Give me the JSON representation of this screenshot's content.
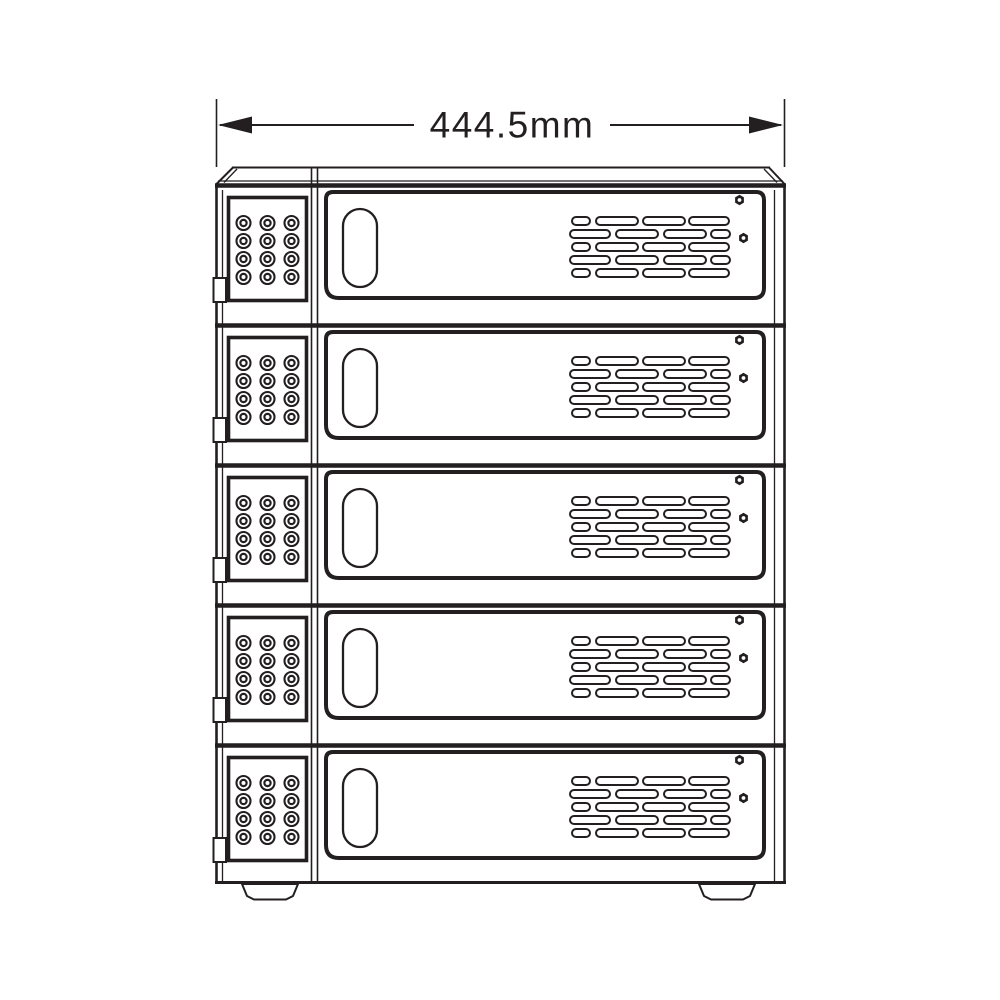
{
  "drawing": {
    "title": "5-bay enclosure front elevation technical drawing",
    "view": "front",
    "bay_count": 5,
    "bays": [
      {
        "id": "bay-1"
      },
      {
        "id": "bay-2"
      },
      {
        "id": "bay-3"
      },
      {
        "id": "bay-4"
      },
      {
        "id": "bay-5"
      }
    ],
    "bay_components": {
      "keypad": {
        "rows": 4,
        "columns": 3,
        "buttons": 12
      },
      "handle": "vertical-oval-handle",
      "vent_rows": 5,
      "vent_slots_per_row": 4,
      "screws_per_bay": 2
    },
    "feet_count": 2
  },
  "dimension": {
    "label": "444.5mm",
    "value_mm": 444.5,
    "measured_edge": "overall-width"
  },
  "icons": {
    "keypad_button": "double-circle",
    "screw": "hex-nut",
    "handle": "vertical-pill",
    "vent_slot": "rounded-slot",
    "arrow_left": "filled-triangle-left",
    "arrow_right": "filled-triangle-right"
  },
  "colors": {
    "line": "#231f20",
    "background": "#ffffff"
  }
}
